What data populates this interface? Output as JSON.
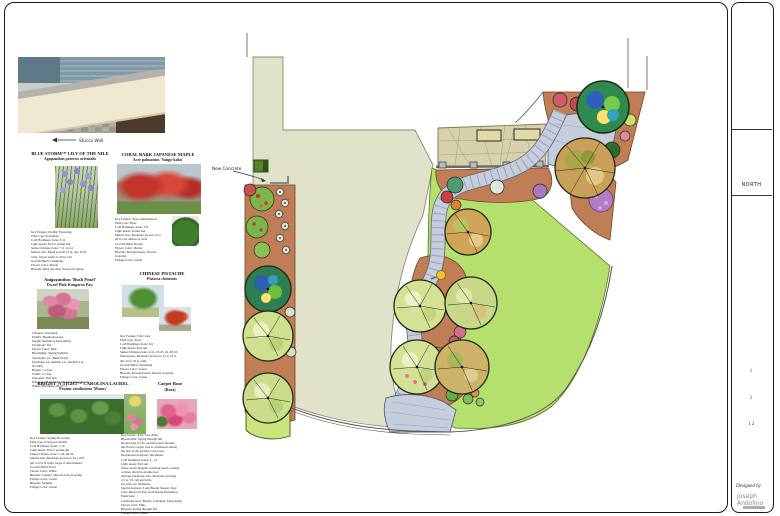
{
  "callouts": {
    "stucco_wall": "Stucco Wall",
    "new_concrete": "New Concrete"
  },
  "title_block": {
    "north": "NORTH",
    "mark1": "1",
    "mark2": "1",
    "mark3": "1 2",
    "designed_by": "Designed by",
    "designer": "Joseph Andolino"
  },
  "colors": {
    "slab": "#e0e3c9",
    "lawn": "#b5e06e",
    "bed": "#bf7e55",
    "path": "#c6cede",
    "plaza": "#d8d2ac"
  },
  "plants": [
    {
      "title": "BLUE STORM™ LILY OF THE NILE",
      "botanical": "Agapanthus praecox orientalis",
      "specs": "Key Feature: Prolific Flowering\nPlant type: Perennials\nCold Hardiness Zone: 8-11\nLight needs: Full to partial sun\nSunset Climate Zone: 7-9, 12-24\nMature size: Rapid growth 12 in. tall, 20 in.\nwide; flower stems to 30 in. tall.\nGrowth Habit: Clumping\nFlower Color: Purple\nBlooms: Deep sky-blue flowers in spring"
    },
    {
      "title": "CORAL BARK JAPANESE MAPLE",
      "botanical": "Acer palmatum 'Sango-kaku'",
      "specs": "Key Feature: Year-round Interest\nPlant type: Trees\nCold Hardiness Zone: 5-8\nLight needs: Partial sun\nMature size: Moderate grower 15 to\n20 ft. tall, almost as wide\nGrowth Habit: Round\nFlower Color: Purple\nBlooms: Inconspicuous; flowers\nin spring\nFoliage Color: Green"
    },
    {
      "title": "Anigozanthos 'Bush Pearl'",
      "botanical": "Dwarf Pink Kangaroo Paw",
      "specs": "Category: Perennial\nFamily: Haemodoraceae\nOrigin: Australia (Australasia)\nEvergreen: Yes\nFlower Color: Pink\nBloomtime: Spring/Summer\nSynonyms: [A. 'Bush Pearl']\nParentage: (A. humilis x A. flavidus x A.\nflavidus)\nHeight: 1-2 feet\nWidth: 1-2 feet\nExposure: Full Sun\nIrrigation (H2O Info): Medium Water Needs\nWinter Hardiness: 20-25° F"
    },
    {
      "title": "CHINESE PISTACHE",
      "botanical": "Pistacia chinensis",
      "specs": "Key Feature: Fall Color\nPlant type: Trees\nCold Hardiness Zone: 6-9\nLight needs: Full sun\nSunset Climate Zone: 4-16, 18-23, 26, 28-33\nMature size: Moderate grower to 25 to 35 ft.\ntall, 25 to 35 ft. wide\nGrowth Habit: Spreading\nFlower Color: Green\nBlooms: Inconspicuous; flowers in spring\nFoliage Color: Green"
    },
    {
      "title": "BRIGHT 'N TIGHT™ CAROLINA LAUREL",
      "botanical": "Prunus caroliniana 'Monus'",
      "specs": "Key Feature: Spring Flowering\nPlant type: Evergreen Shrubs\nCold Hardiness Zone: 7-10\nLight needs: Full to partial sun\nSunset Climate Zone: 7-24, 26-29\nMature size: Moderate grower to 8 to 10 ft.\ntall, 6 to 8 ft. wide; larger if unrestrained.\nGrowth Habit: Erect\nFlower Color: White\nBlooms: Creamy white flowers in spring\nFoliage Color: Green\nBlooms: Summer\nFoliage Color: Green"
    },
    {
      "title": "Carpet Rose",
      "botanical": "(Rosa)",
      "specs": "Key feature: Easy Care Plant\nBloom time: Spring through fall\nKnown best for its colorful repeat blooms,\nthe Flower Carpet rose is considered among\nthe best of the ground cover roses\nDeciduous/evergreen: Deciduous\nCold hardiness zones: 4 - 10\nLight needs: Full sun\nWater needs: Regular watering needs; weekly,\nor more often in extreme heat\nAverage landscape size: Moderate growing\n2.5 to 3 ft. tall and wide\nGrowth rate: Moderate\nSpecial features: Long Bloom Season, Easy\nCare, Improved Pest and Disease Resistance,\nWaterwise\nLandscape uses: Border, Container, Firescaping\nFlower color: Pink\nBlooms: Spring through fall\nFoliage color: Green"
    }
  ]
}
